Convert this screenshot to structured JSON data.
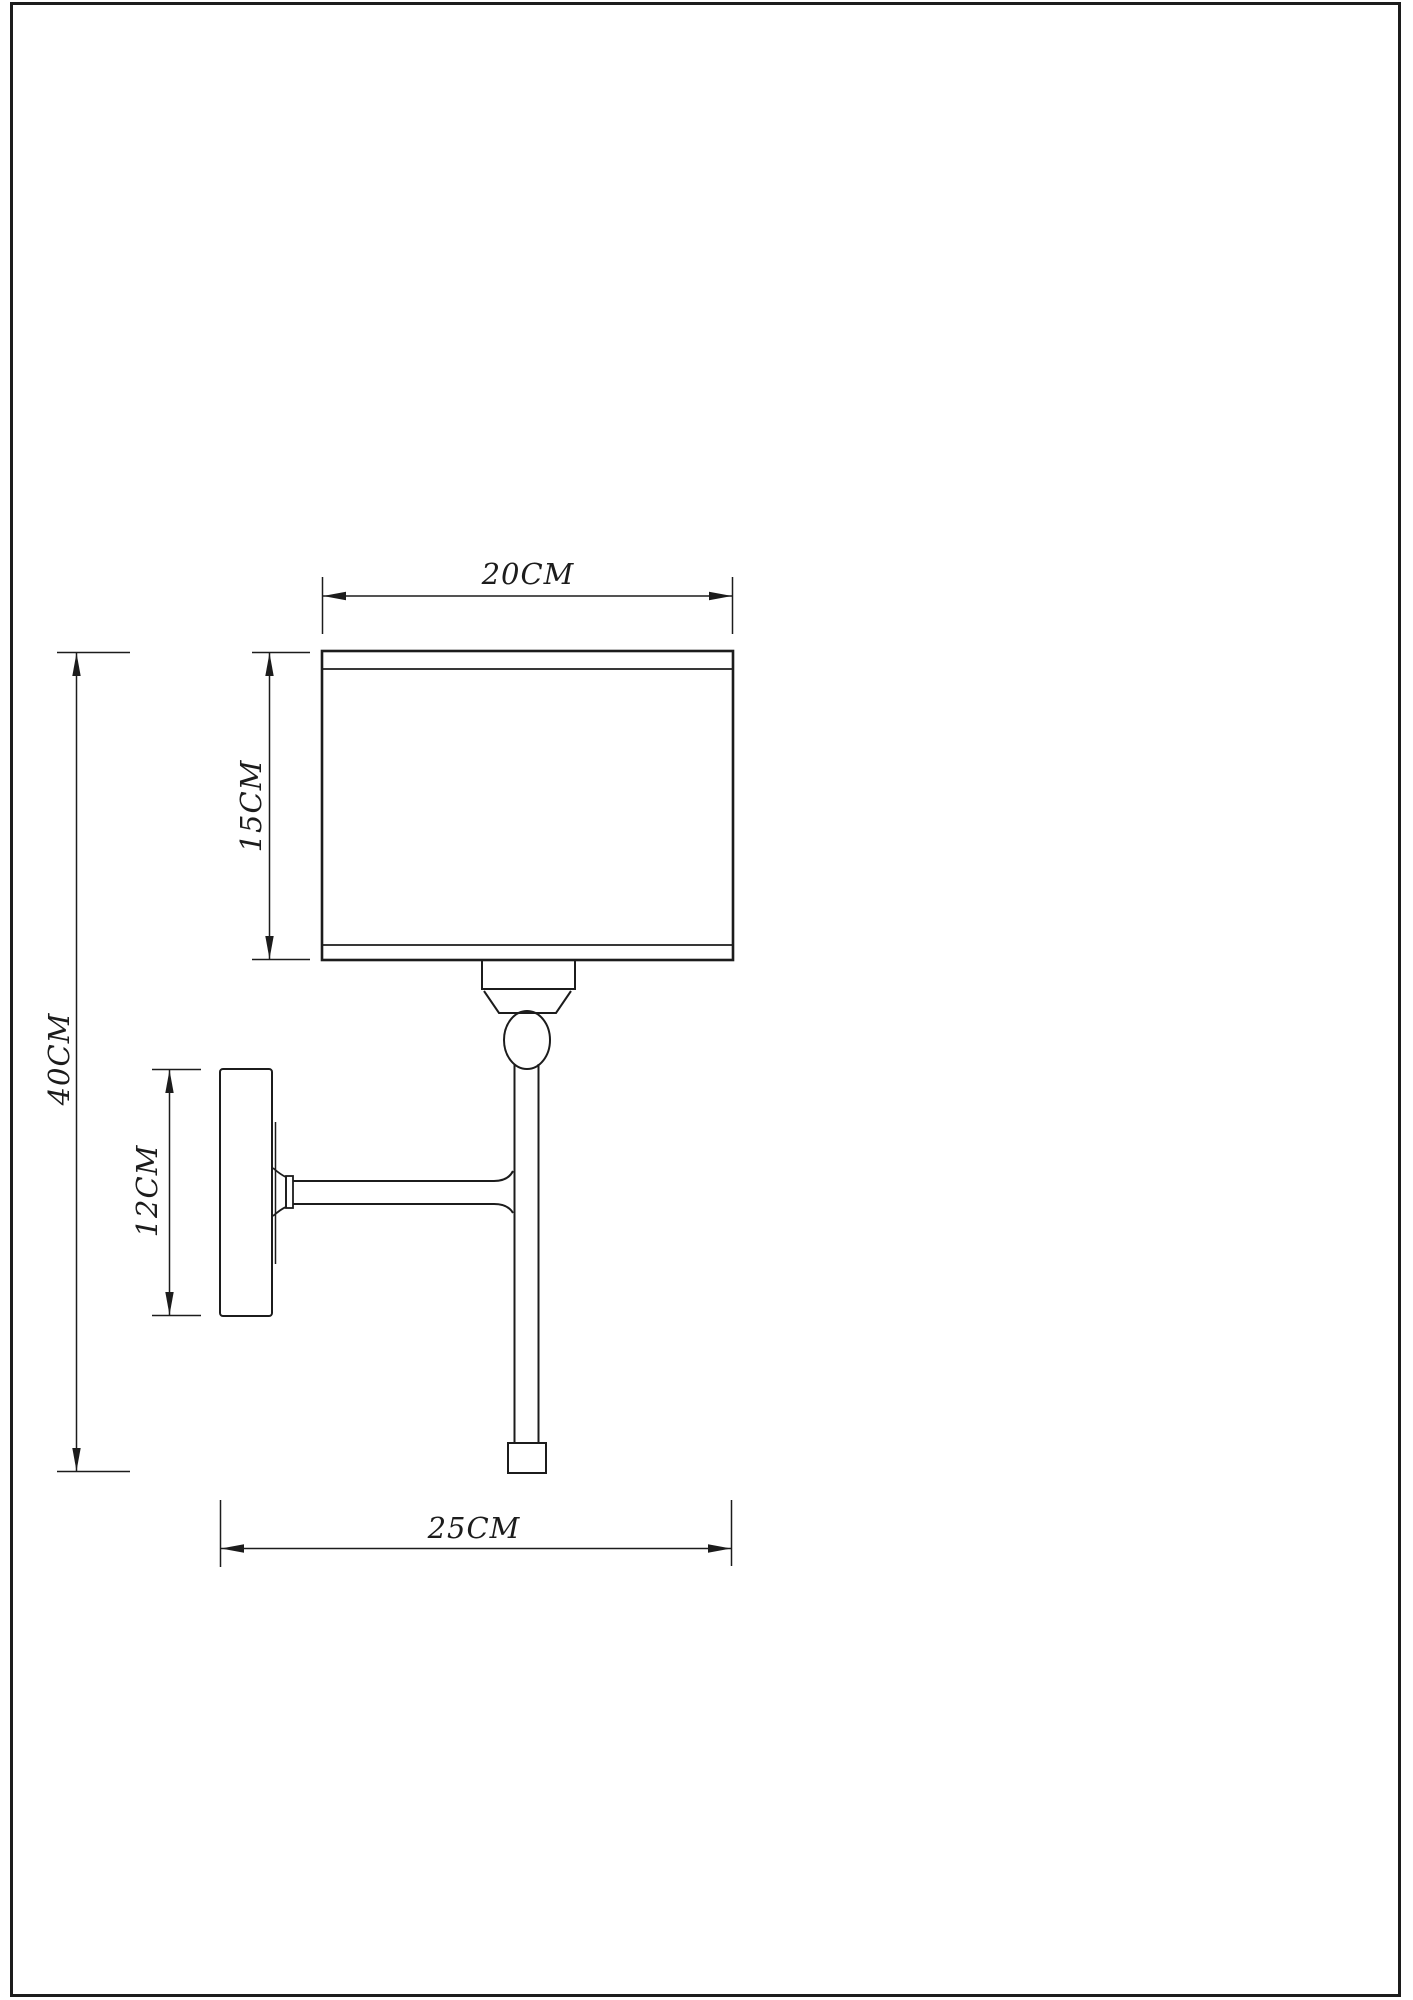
{
  "drawing": {
    "background": "#ffffff",
    "line_color": "#1c1c1c",
    "dimensions": [
      {
        "id": "shade-width",
        "label": "20CM",
        "value_cm": 20,
        "orientation": "horizontal"
      },
      {
        "id": "shade-height",
        "label": "15CM",
        "value_cm": 15,
        "orientation": "vertical"
      },
      {
        "id": "total-height",
        "label": "40CM",
        "value_cm": 40,
        "orientation": "vertical"
      },
      {
        "id": "backplate-height",
        "label": "12CM",
        "value_cm": 12,
        "orientation": "vertical"
      },
      {
        "id": "wall-projection",
        "label": "25CM",
        "value_cm": 25,
        "orientation": "horizontal"
      }
    ]
  }
}
